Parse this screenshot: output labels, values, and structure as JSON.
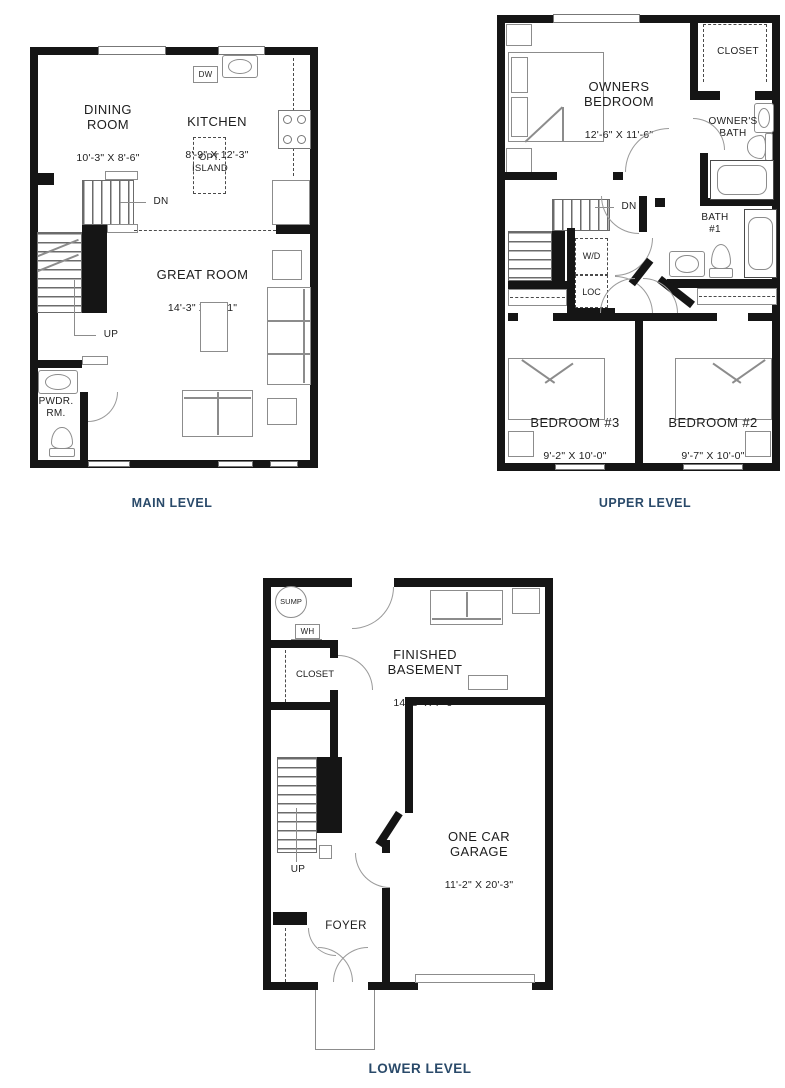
{
  "colors": {
    "wall": "#151515",
    "caption": "#2a4a6a",
    "room_text": "#1d1d1d",
    "furniture_line": "#8c8c8c"
  },
  "main_level": {
    "caption": "MAIN LEVEL",
    "rooms": {
      "dining": {
        "name": "DINING\nROOM",
        "dims": "10'-3\" X 8'-6\""
      },
      "kitchen": {
        "name": "KITCHEN",
        "dims": "8'-9\" X 12'-3\""
      },
      "great": {
        "name": "GREAT ROOM",
        "dims": "14'-3\" X 16'-1\""
      },
      "powder": {
        "name": "PWDR.\nRM."
      }
    },
    "labels": {
      "dishwasher": "DW",
      "island": "OPT.\nISLAND",
      "stairs_down": "DN",
      "stairs_up": "UP"
    }
  },
  "upper_level": {
    "caption": "UPPER LEVEL",
    "rooms": {
      "owners_bedroom": {
        "name": "OWNERS\nBEDROOM",
        "dims": "12'-6\" X 11'-6\""
      },
      "closet": {
        "name": "CLOSET"
      },
      "owners_bath": {
        "name": "OWNER'S\nBATH"
      },
      "bath1": {
        "name": "BATH\n#1"
      },
      "bedroom3": {
        "name": "BEDROOM #3",
        "dims": "9'-2\" X 10'-0\""
      },
      "bedroom2": {
        "name": "BEDROOM #2",
        "dims": "9'-7\" X 10'-0\""
      }
    },
    "labels": {
      "stairs_down": "DN",
      "washer_dryer": "W/D",
      "linen_closet": "LOC"
    }
  },
  "lower_level": {
    "caption": "LOWER LEVEL",
    "rooms": {
      "basement": {
        "name": "FINISHED\nBASEMENT",
        "dims": "14'-2\" X 7'-9\""
      },
      "garage": {
        "name": "ONE CAR\nGARAGE",
        "dims": "11'-2\" X 20'-3\""
      },
      "foyer": {
        "name": "FOYER"
      },
      "closet": {
        "name": "CLOSET"
      }
    },
    "labels": {
      "sump": "SUMP",
      "water_heater": "WH",
      "stairs_up": "UP"
    }
  }
}
